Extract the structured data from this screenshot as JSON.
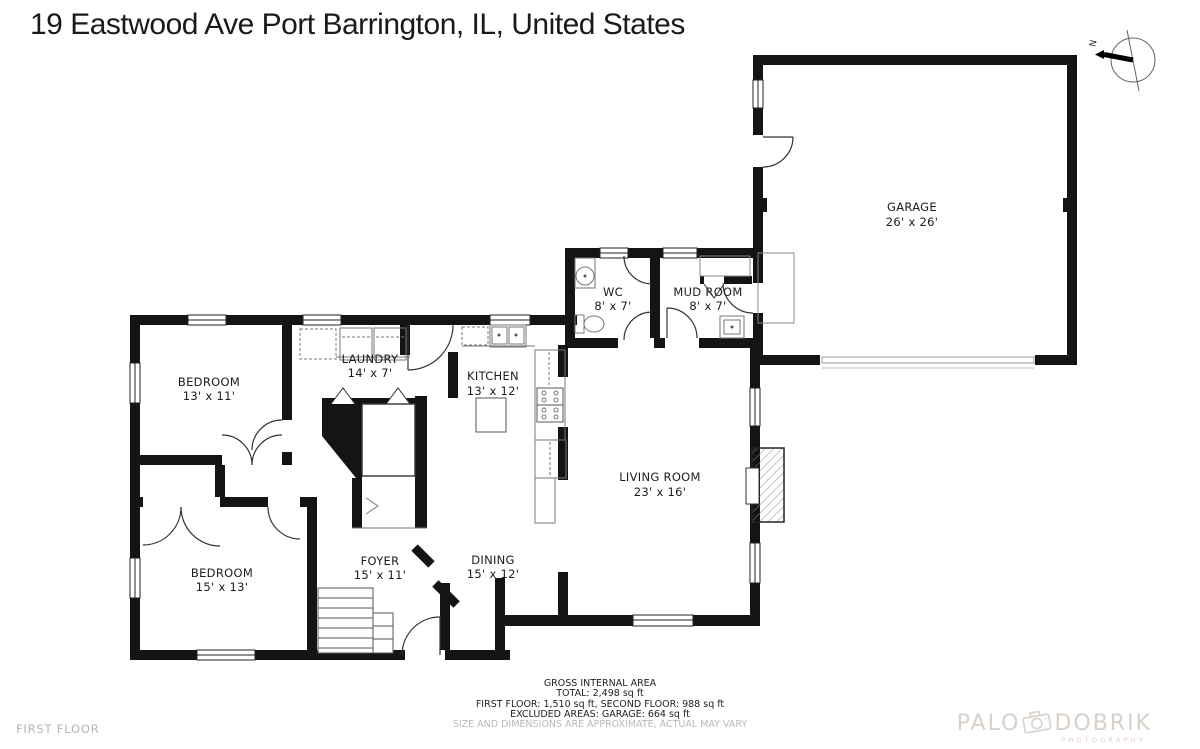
{
  "address": "19 Eastwood Ave Port Barrington, IL, United States",
  "compass": {
    "north_label": "N"
  },
  "rooms": [
    {
      "id": "garage",
      "name": "GARAGE",
      "dims": "26' x 26'"
    },
    {
      "id": "wc",
      "name": "WC",
      "dims": "8' x 7'"
    },
    {
      "id": "mud-room",
      "name": "MUD ROOM",
      "dims": "8' x 7'"
    },
    {
      "id": "laundry",
      "name": "LAUNDRY",
      "dims": "14' x 7'"
    },
    {
      "id": "kitchen",
      "name": "KITCHEN",
      "dims": "13' x 12'"
    },
    {
      "id": "bedroom-1",
      "name": "BEDROOM",
      "dims": "13' x 11'"
    },
    {
      "id": "living-room",
      "name": "LIVING ROOM",
      "dims": "23' x 16'"
    },
    {
      "id": "bedroom-2",
      "name": "BEDROOM",
      "dims": "15' x 13'"
    },
    {
      "id": "foyer",
      "name": "FOYER",
      "dims": "15' x 11'"
    },
    {
      "id": "dining",
      "name": "DINING",
      "dims": "15' x 12'"
    }
  ],
  "area_summary": {
    "heading": "GROSS INTERNAL AREA",
    "total": "TOTAL: 2,498 sq ft",
    "floors": "FIRST FLOOR: 1,510 sq ft, SECOND FLOOR: 988 sq ft",
    "excluded": "EXCLUDED AREAS: GARAGE: 664 sq ft",
    "disclaimer": "SIZE AND DIMENSIONS ARE APPROXIMATE, ACTUAL MAY VARY"
  },
  "floor_label": "FIRST FLOOR",
  "watermark": {
    "word1": "PALO",
    "word2": "DOBRIK",
    "subtitle": "PHOTOGRAPHY"
  },
  "colors": {
    "walls": "#141414",
    "thin_lines": "#777777",
    "label_text": "#1c1c1c",
    "muted_text": "#b5b5b5",
    "watermark": "#d8d0ca",
    "background": "#ffffff"
  }
}
